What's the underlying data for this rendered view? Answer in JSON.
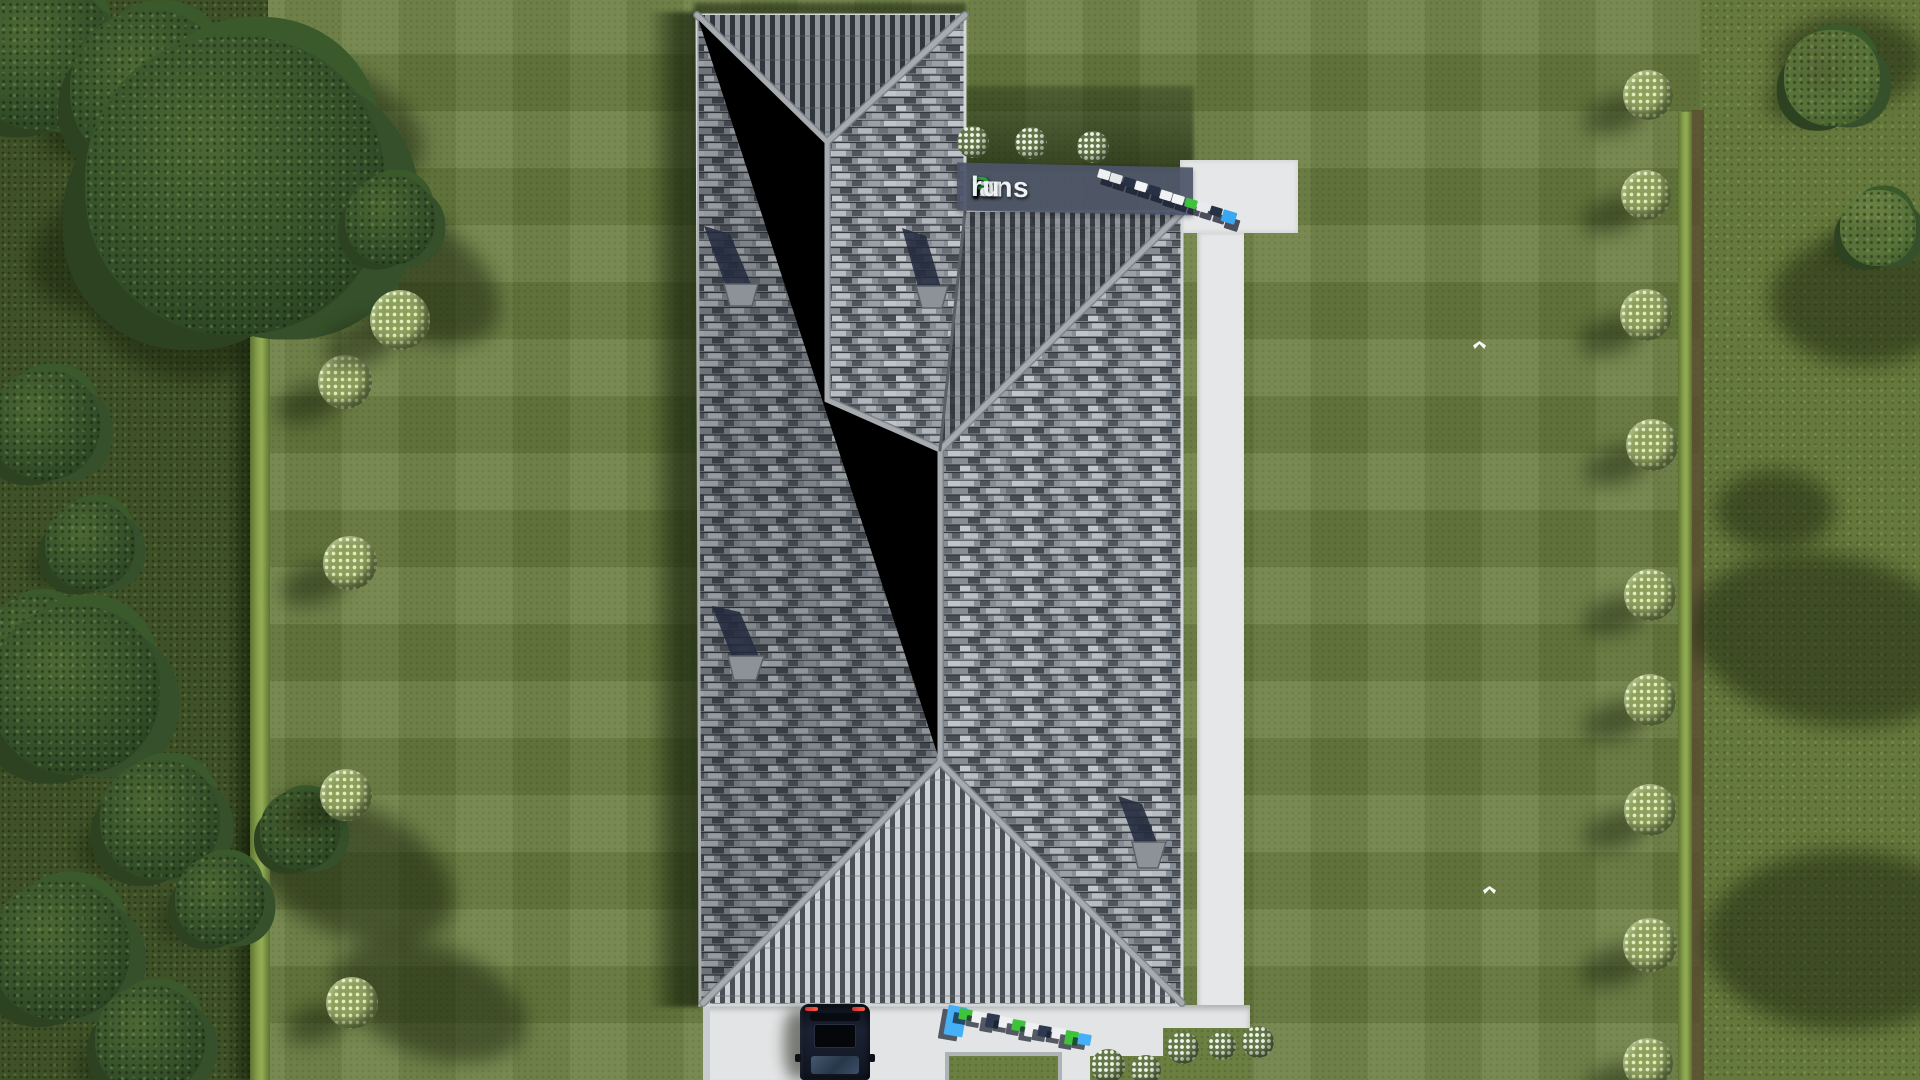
{
  "scene": {
    "title": "Aerial top-down 3D render of a house with a gray shingled hip roof on a landscaped lawn",
    "watermark_band": {
      "f": "F",
      "ix": "ix",
      "p": "P",
      "lans": "lans",
      "dot": ".",
      "ru": "ru",
      "full": "FixPlans.ru"
    },
    "colors": {
      "lawn": "#6b7f41",
      "meadow": "#66793c",
      "wild_strip": "#3f5227",
      "hedge": "#8aa34e",
      "roof_base": "#878d94",
      "roof_tile_light": "#b7bcc1",
      "roof_tile_dark": "#464b52",
      "ridge": "#a6abb0",
      "path_concrete": "#e6e7e8",
      "watermark_band_bg": "#4c5468",
      "brand_blue": "#2946d6",
      "brand_green": "#27a32a",
      "car_body": "#1b2233",
      "taillight_red": "#d03030",
      "flower_bush_white": "#f4f7ee",
      "w3d_top_colors": [
        "#eef0f2",
        "#e4e7ea",
        "#273146",
        "#f2f4f6",
        "#273146",
        "#eef0f2",
        "#f2f4f6",
        "#3fc23c",
        "#e8ebee",
        "#273146",
        "#3aa8f0"
      ],
      "w3d_bottom_colors": [
        "#45b0f5",
        "#3fc23c",
        "#eef0f2",
        "#2e3850",
        "#eef0f2",
        "#3fc23c",
        "#eef0f2",
        "#2e3850",
        "#eef0f2",
        "#3fc23c",
        "#45b0f5"
      ]
    },
    "objects": {
      "house_roof": "L-shaped gray shingle hip roof with light ridge caps",
      "chimney_count": 4,
      "car_count": 1,
      "bird_count": 2,
      "right_row_bush_count": 9,
      "left_lawn_bush_count": 5,
      "white_flower_bush_count": 8,
      "watermark_count": 3
    }
  }
}
